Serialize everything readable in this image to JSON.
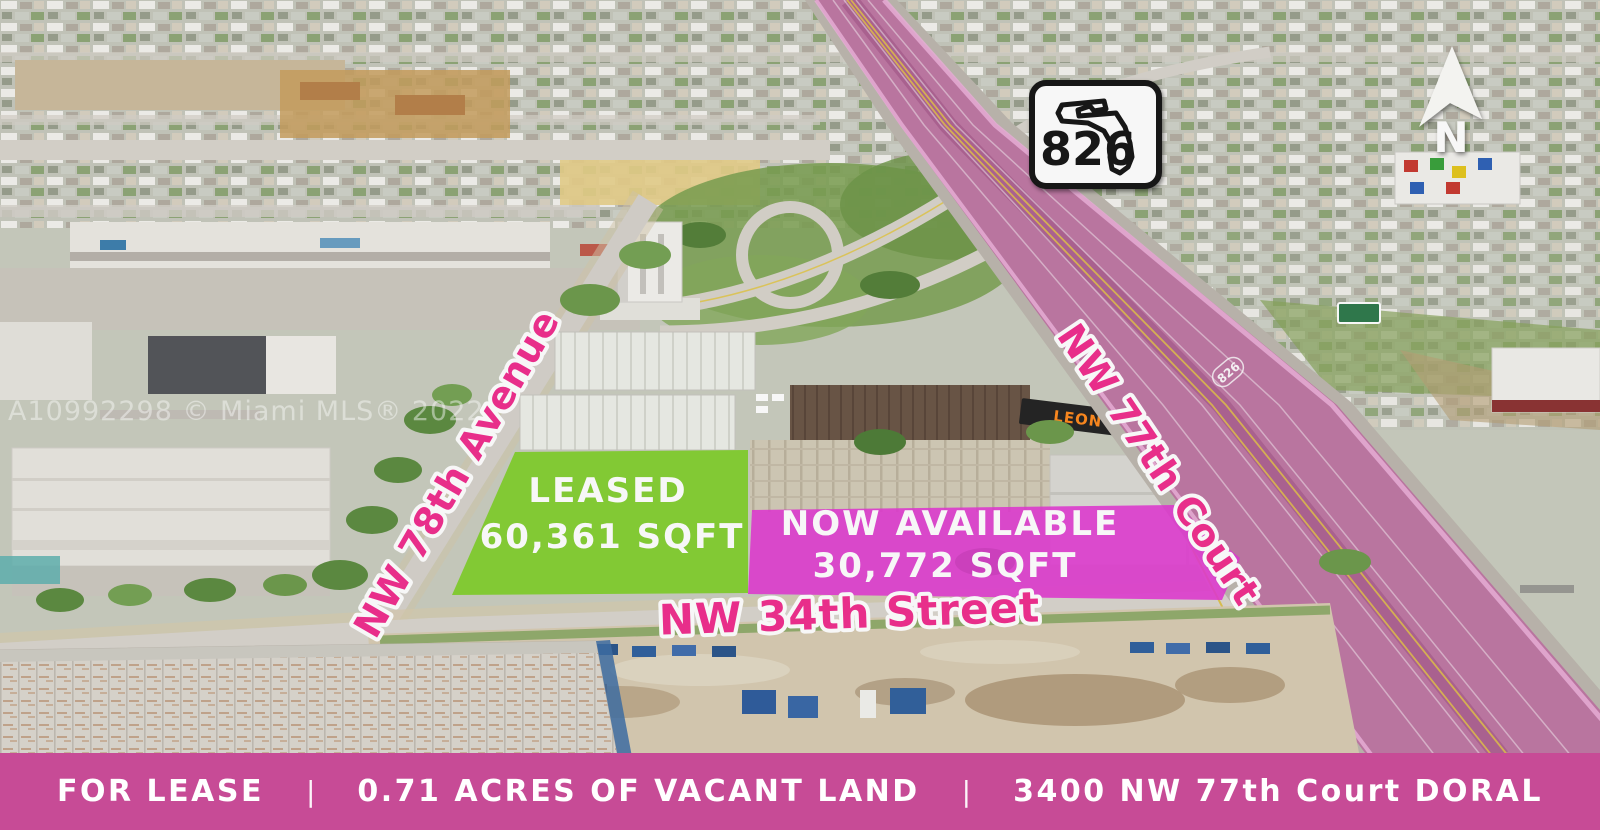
{
  "image": {
    "watermark": "A10992298 © Miami MLS® 2022"
  },
  "compass": {
    "north_label": "N"
  },
  "route_shield": {
    "number": "826"
  },
  "road_marker": {
    "number": "826"
  },
  "billboard": {
    "label": "LEON"
  },
  "parcels": {
    "leased": {
      "status": "LEASED",
      "area": "60,361 SQFT",
      "color": "#7cd022"
    },
    "available": {
      "status": "NOW AVAILABLE",
      "area": "30,772 SQFT",
      "color": "#e337d4"
    }
  },
  "streets": {
    "label_color": "#f02e8e",
    "avenue_78": "NW 78th Avenue",
    "court_77": "NW 77th Court",
    "street_34": "NW 34th Street"
  },
  "banner": {
    "color": "#c74b96",
    "separator": "|",
    "items": [
      {
        "label": "FOR LEASE"
      },
      {
        "label": "0.71 ACRES OF VACANT LAND"
      },
      {
        "label": "3400 NW 77th Court DORAL"
      }
    ]
  }
}
